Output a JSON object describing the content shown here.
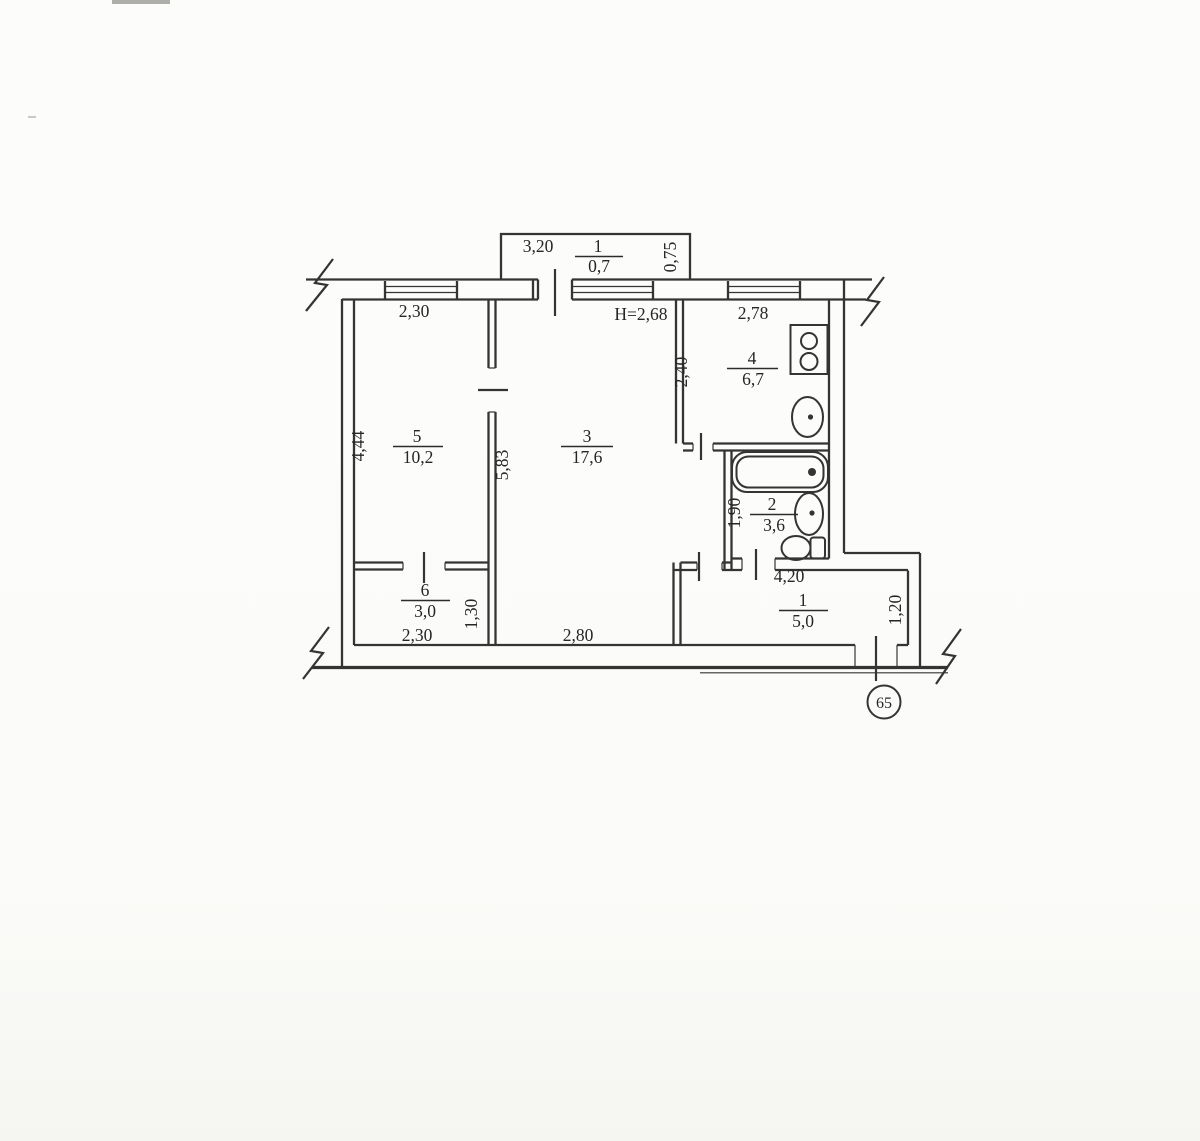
{
  "colors": {
    "ink": "#343434",
    "paper": "#fbfbf9"
  },
  "apartment": {
    "number_badge": "65",
    "ceiling_height": "H=2,68"
  },
  "rooms": {
    "hallway": {
      "number": "1",
      "area": "5,0"
    },
    "bathroom": {
      "number": "2",
      "area": "3,6"
    },
    "living": {
      "number": "3",
      "area": "17,6"
    },
    "kitchen": {
      "number": "4",
      "area": "6,7"
    },
    "bedroom": {
      "number": "5",
      "area": "10,2"
    },
    "closet": {
      "number": "6",
      "area": "3,0"
    },
    "balcony": {
      "number": "1",
      "area": "0,7"
    }
  },
  "dimensions": {
    "balcony_width": "3,20",
    "balcony_depth": "0,75",
    "bedroom_window_wall": "2,30",
    "kitchen_window_wall": "2,78",
    "bedroom_depth": "4,44",
    "living_partition": "5,83",
    "kitchen_depth": "2,40",
    "bathroom_depth": "1,90",
    "closet_depth": "1,30",
    "closet_width": "2,30",
    "living_width": "2,80",
    "hallway_width": "4,20",
    "entry_depth": "1,20"
  }
}
